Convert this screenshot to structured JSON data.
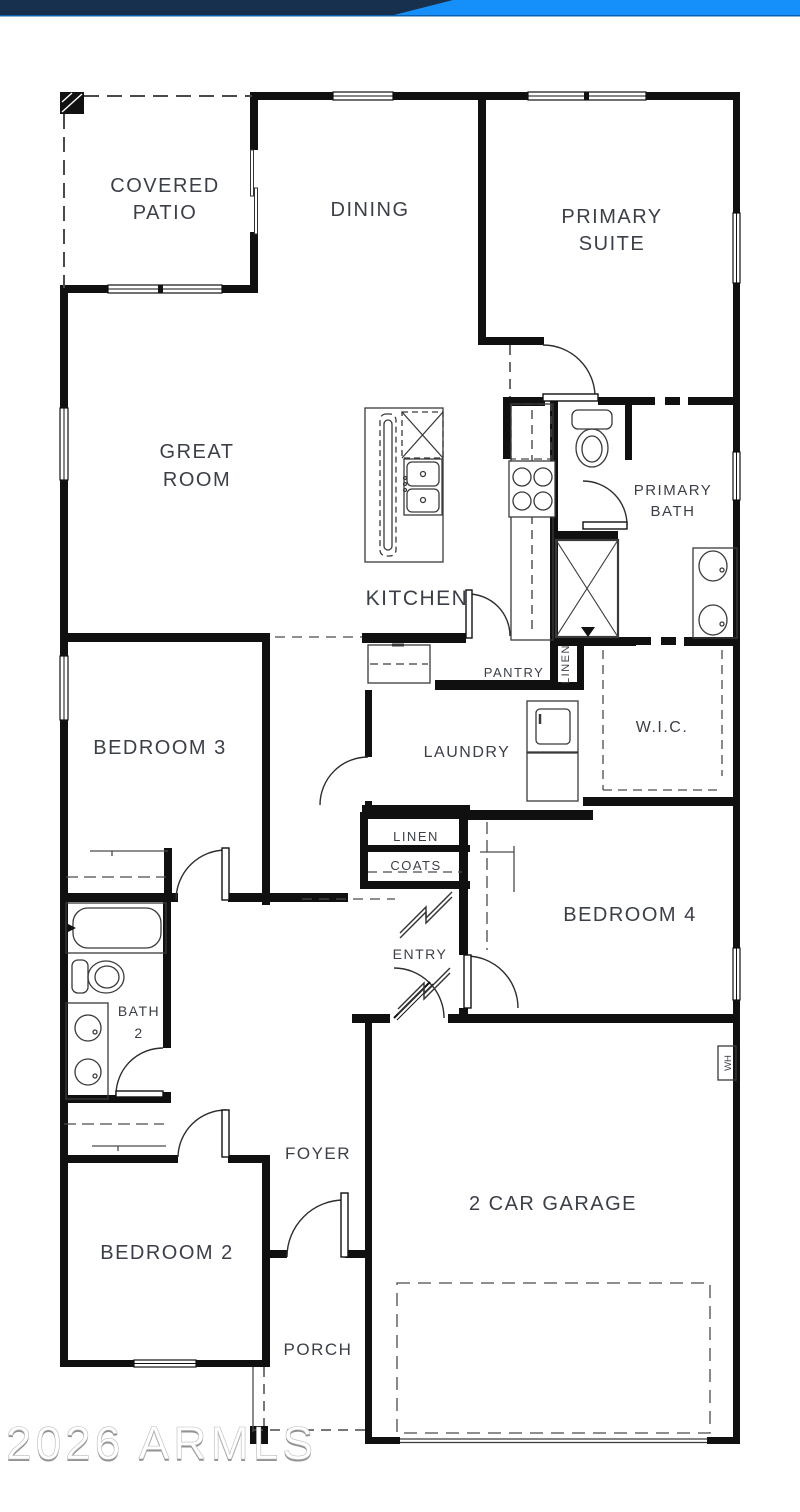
{
  "banner": {
    "navy": "#16304d",
    "blue": "#1590fa",
    "edge": "#0a5fae"
  },
  "watermark": {
    "text": "2026 ARMLS"
  },
  "rooms": {
    "covered_patio_l1": "COVERED",
    "covered_patio_l2": "PATIO",
    "dining": "DINING",
    "primary_suite_l1": "PRIMARY",
    "primary_suite_l2": "SUITE",
    "great_room_l1": "GREAT",
    "great_room_l2": "ROOM",
    "kitchen": "KITCHEN",
    "primary_bath_l1": "PRIMARY",
    "primary_bath_l2": "BATH",
    "pantry": "PANTRY",
    "linen_closet_vertical": "LINEN",
    "wic": "W.I.C.",
    "laundry": "LAUNDRY",
    "bedroom3": "BEDROOM 3",
    "linen": "LINEN",
    "coats": "COATS",
    "bedroom4": "BEDROOM 4",
    "entry": "ENTRY",
    "bath2_l1": "BATH",
    "bath2_l2": "2",
    "foyer": "FOYER",
    "garage": "2 CAR GARAGE",
    "bedroom2": "BEDROOM 2",
    "porch": "PORCH",
    "water_heater": "WH"
  }
}
